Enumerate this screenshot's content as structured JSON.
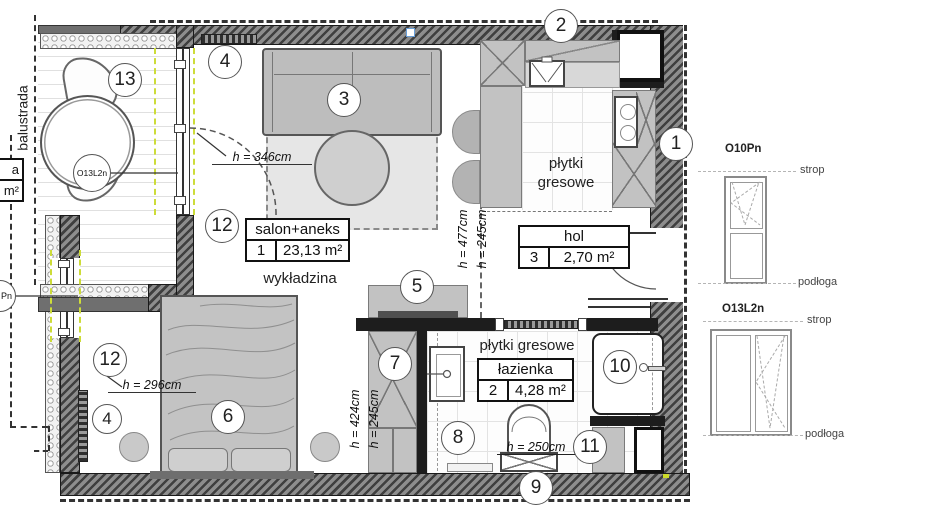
{
  "balcony": {
    "railing": "balustrada",
    "window_tag": "O13L2n"
  },
  "edge": {
    "row1": "a",
    "row2": "m²",
    "window_tag": "Pn"
  },
  "markers": {
    "k1": "1",
    "k2": "2",
    "k3": "3",
    "k4": "4",
    "k5": "5",
    "k6": "6",
    "k7": "7",
    "k8": "8",
    "k9": "9",
    "k10": "10",
    "k11": "11",
    "k12": "12",
    "k13": "13"
  },
  "rooms": {
    "salon": {
      "label": "salon+aneks",
      "num": "1",
      "area": "23,13 m²"
    },
    "hol": {
      "label": "hol",
      "num": "3",
      "area": "2,70 m²"
    },
    "bath": {
      "label": "łazienka",
      "num": "2",
      "area": "4,28 m²"
    }
  },
  "floors": {
    "salon": "wykładzina",
    "kitchen": "płytki gresowe",
    "bath": "płytki gresowe"
  },
  "heights": {
    "salon": "h = 346cm",
    "salon2": "h = 296cm",
    "kitchen_a": "h = 245cm",
    "kitchen_b": "h = 477cm",
    "wardrobe_a": "h = 424cm",
    "wardrobe_b": "h = 245cm",
    "bath": "h = 250cm"
  },
  "legend": {
    "win1": {
      "code": "O10Pn",
      "top": "strop",
      "bottom": "podłoga"
    },
    "win2": {
      "code": "O13L2n",
      "top": "strop",
      "bottom": "podłoga"
    }
  },
  "colors": {
    "insulation_marker": "#cddc39",
    "wall": "#3f3f3f",
    "furniture": "#c2c2c2"
  }
}
